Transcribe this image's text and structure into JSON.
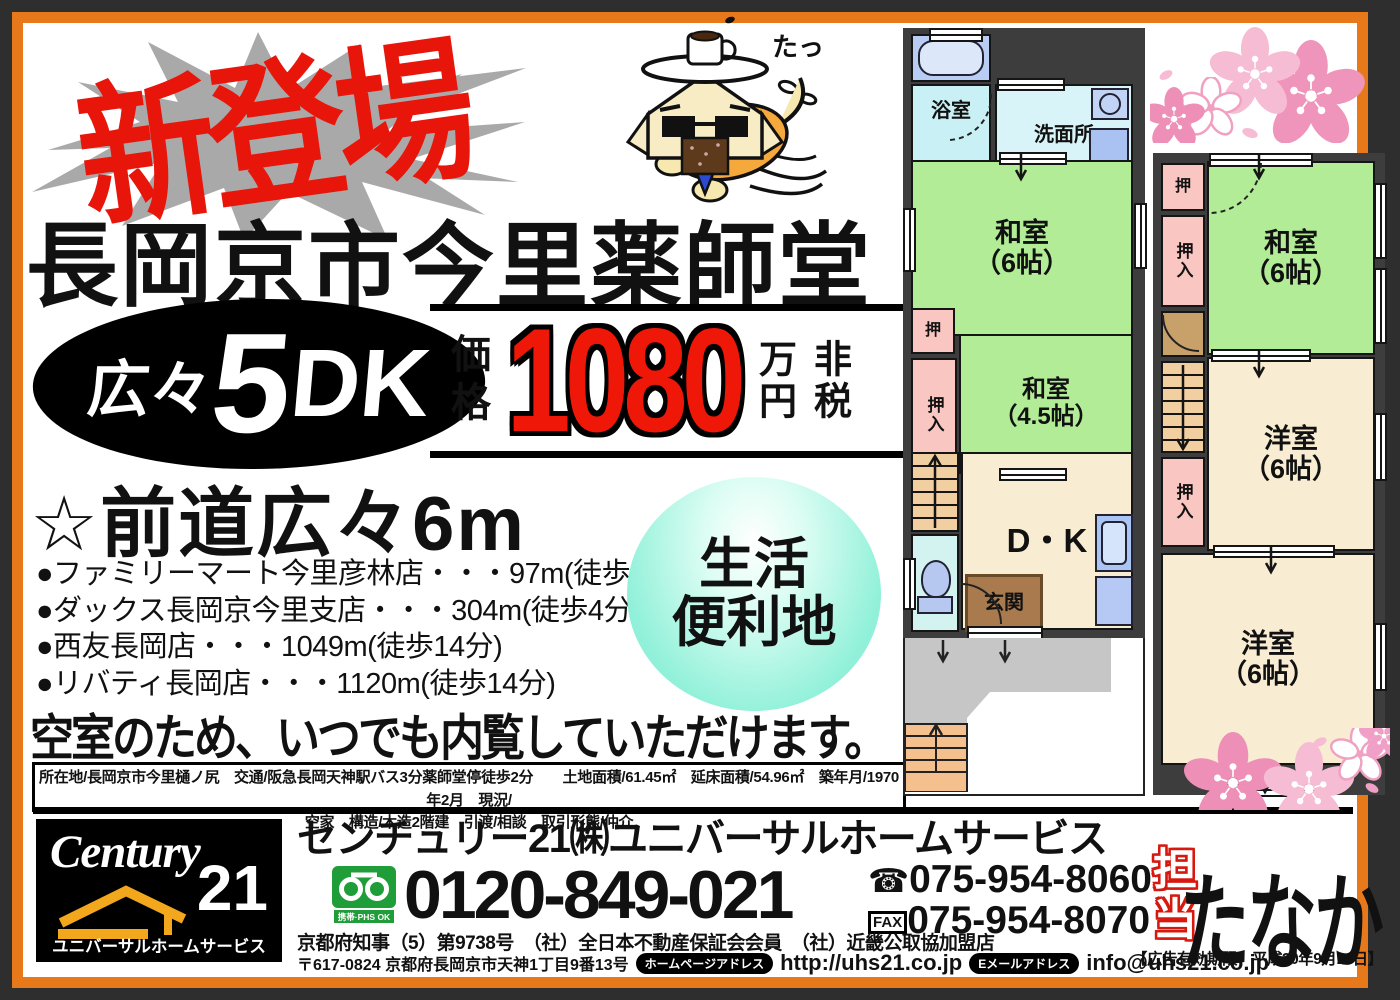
{
  "banner": {
    "text": "新登場"
  },
  "mascot": {
    "sound_effect": "たっ"
  },
  "headline": "長岡京市今里薬師堂",
  "layout_badge": {
    "prefix": "広々",
    "number": "5",
    "letters": "DK"
  },
  "price": {
    "label": "価格",
    "amount": "1080",
    "unit": "万円",
    "tax": "非税"
  },
  "road_note": "☆前道広々6m",
  "nearby": {
    "items": [
      "●ファミリーマート今里彦林店・・・97m(徒歩2分)",
      "●ダックス長岡京今里支店・・・304m(徒歩4分)",
      "●西友長岡店・・・1049m(徒歩14分)",
      "●リバティ長岡店・・・1120m(徒歩14分)"
    ]
  },
  "life_badge": "生活\n便利地",
  "vacancy_note": "空室のため、いつでも内覧していただけます。",
  "property_details": {
    "line1": "所在地/長岡京市今里樋ノ尻　交通/阪急長岡天神駅バス3分薬師堂停徒歩2分　　土地面積/61.45㎡　延床面積/54.96㎡　築年月/1970年2月　現況/",
    "line2": "空家　構造/木造2階建　引渡/相談　取引形態/仲介"
  },
  "footer": {
    "logo": {
      "brand": "Century",
      "number": "21",
      "subtitle": "ユニバーサルホームサービス"
    },
    "company_name": "センチュリー21㈱ユニバーサルホームサービス",
    "freedial": {
      "phs_label": "携帯·PHS OK",
      "number": "0120-849-021"
    },
    "tel": {
      "icon": "☎",
      "number": "075-954-8060"
    },
    "fax": {
      "label": "FAX",
      "number": "075-954-8070"
    },
    "license": "京都府知事（5）第9738号　（社）全日本不動産保証会会員　（社）近畿公取協加盟店",
    "address": "〒617-0824 京都府長岡京市天神1丁目9番13号",
    "homepage": {
      "label": "ホームページアドレス",
      "url": "http://uhs21.co.jp"
    },
    "email": {
      "label": "Eメールアドレス",
      "address": "info@uhs21.co.jp"
    },
    "agent": {
      "label": "担当",
      "name": "たなか"
    },
    "expiry": "【広告有効期限　平成30年9月10日】"
  },
  "plan1f": {
    "bath": "浴室",
    "washroom": "洗面所",
    "washitsu6": "和室\n（6帖）",
    "oshi": "押",
    "oshiire": "押入",
    "washitsu45": "和室\n（4.5帖）",
    "dk": "D・K",
    "genkan": "玄関"
  },
  "plan2f": {
    "oshi": "押",
    "washitsu6": "和室\n（6帖）",
    "oshiire_upper": "押入",
    "oshiire_lower": "押入",
    "youshitsu_mid": "洋室\n（6帖）",
    "youshitsu_bottom": "洋室\n（6帖）"
  }
}
